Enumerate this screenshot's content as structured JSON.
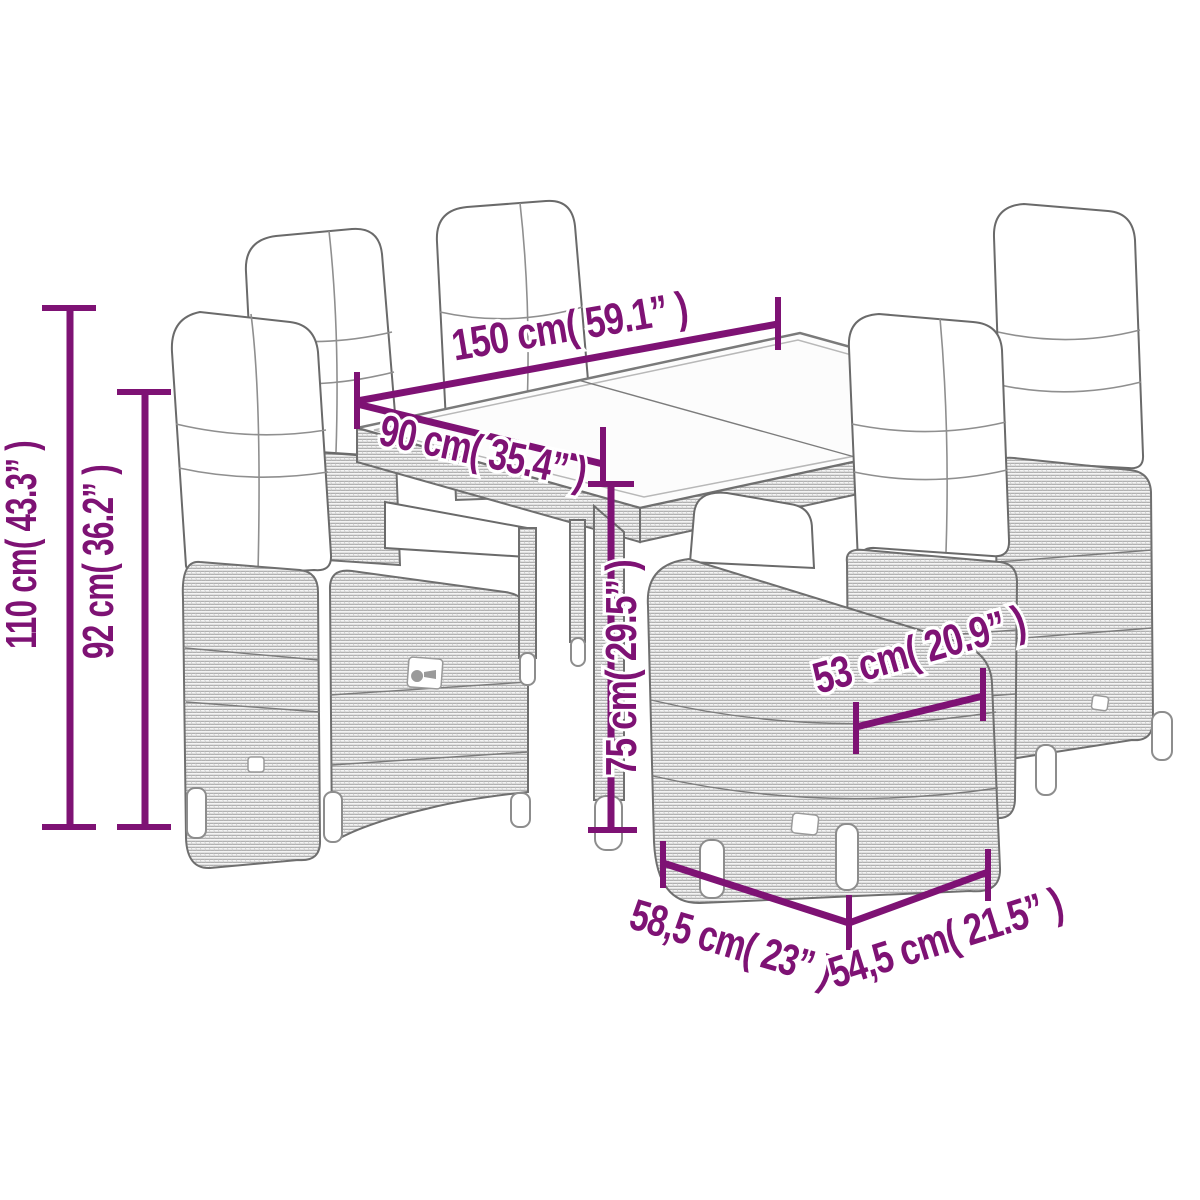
{
  "diagram": {
    "type": "product-dimension-diagram",
    "subject": "7-piece rattan garden dining set: glass-top table with six reclining cushioned chairs",
    "accent_color": "#7E1274",
    "furniture_line_color": "#6F6F6F",
    "background_color": "#FFFFFF",
    "units": [
      "cm",
      "inches"
    ]
  },
  "dimensions": {
    "table_length": {
      "label": "150 cm( 59.1”  )",
      "cm": 150,
      "inches": 59.1
    },
    "table_width": {
      "label": "90 cm( 35.4”  )",
      "cm": 90,
      "inches": 35.4
    },
    "chair_total_height": {
      "label": "110 cm( 43.3”  )",
      "cm": 110,
      "inches": 43.3
    },
    "chair_backrest_height": {
      "label": "92 cm( 36.2”  )",
      "cm": 92,
      "inches": 36.2
    },
    "table_height": {
      "label": "75 cm( 29.5”  )",
      "cm": 75,
      "inches": 29.5
    },
    "seat_width": {
      "label": "53 cm( 20.9”  )",
      "cm": 53,
      "inches": 20.9
    },
    "seat_depth": {
      "label": "58,5 cm( 23”  )",
      "cm": 58.5,
      "inches": 23
    },
    "seat_front_width": {
      "label": "54,5 cm( 21.5”  )",
      "cm": 54.5,
      "inches": 21.5
    }
  }
}
